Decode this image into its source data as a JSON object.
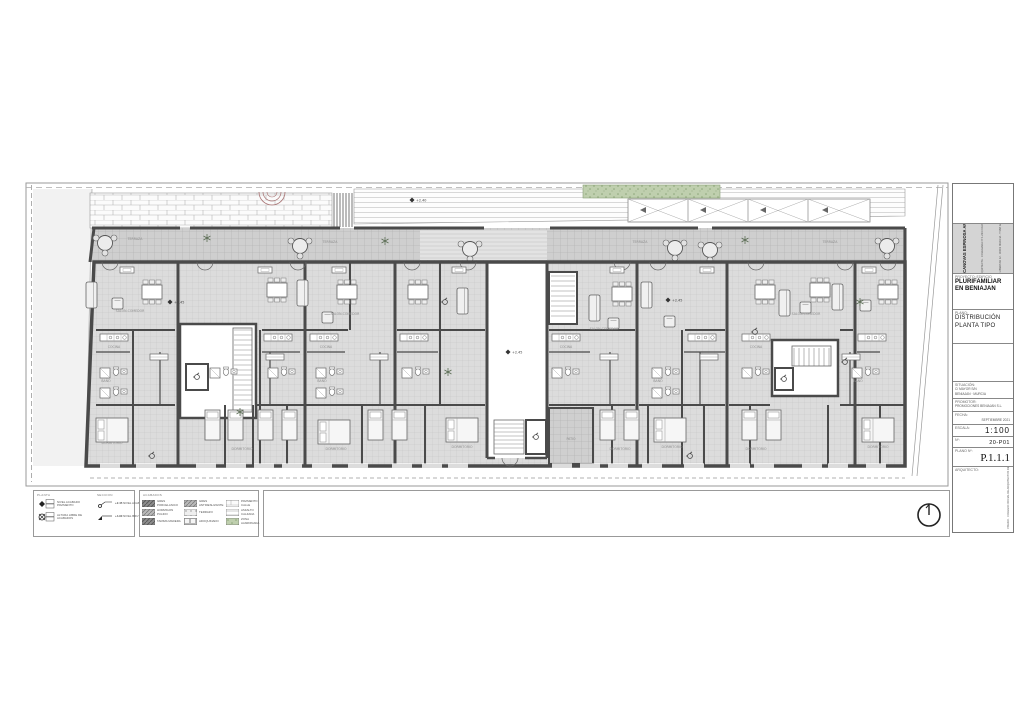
{
  "title_block": {
    "architect_name": "BARBARA CANOVAS ESPINOSA ARQUITECTO",
    "architect_contact1": "ARQUITECTA · COLEGIADA Nº 1.234 COAMU",
    "architect_contact2": "AVDA. LIBERTAD 12 · 30001 MURCIA · T 968 123 456",
    "project_label": "PROYECTO: EDIFICIO",
    "project_line1": "PLURIFAMILIAR",
    "project_line2": "EN BENIAJAN",
    "plano_label": "PLANO:",
    "plano_line1": "DISTRIBUCIÓN",
    "plano_line2": "PLANTA TIPO",
    "situacion_label": "SITUACIÓN:",
    "situacion_line1": "C/ MAYOR S/N",
    "situacion_line2": "BENIAJAN · MURCIA",
    "promotor_label": "PROMOTOR:",
    "promotor_line1": "PROMOCIONES BENIAJAN S.L.",
    "fecha_label": "FECHA:",
    "fecha_value": "SEPTIEMBRE 2021",
    "escala_label": "ESCALA:",
    "escala_value": "1:100",
    "num_label": "Nº:",
    "num_value": "20-P01",
    "plano_num_label": "PLANO Nº:",
    "plano_num_value": "P.1.1.1",
    "firma_label": "ARQUITECTO:",
    "firma_side": "VISADO · COLEGIO OFICIAL DE ARQUITECTOS DE MURCIA"
  },
  "legend": {
    "col1_header": "PLANTA",
    "col1_item1": "NIVEL ACABADO PAVIMENTO",
    "col1_item2": "ALTURA LIBRE DE ACABADOS",
    "col2_header": "SECCION",
    "col2_item1": "NIVEL ACABADO",
    "col2_item2": "NIVEL BRUTO",
    "col2_val1": "+2.45",
    "col2_val2": "+4.90",
    "acabados_header": "ACABADOS",
    "swatches": [
      "GRES PORCELANICO",
      "HORMIGON PULIDO",
      "TARIMA MADERA",
      "GRES ANTIDESLIZANTE",
      "TERRAZO",
      "ADOQUINADO",
      "PAVIMENTO CALLE",
      "ASFALTO CALZADA",
      "ZONA AJARDINADA"
    ]
  },
  "plan": {
    "rooms": {
      "salon": "SALON-COMEDOR",
      "dormitorio": "DORMITORIO",
      "cocina": "COCINA",
      "bano": "BAÑO",
      "terraza": "TERRAZA",
      "patio": "PATIO"
    },
    "levels": {
      "interior": "+2.45",
      "calle": "+2.40"
    },
    "colors": {
      "wall": "#4a4a4a",
      "floor": "#dcdcdc",
      "terrace": "#cfcfcf",
      "green": "#bfcfae"
    }
  }
}
